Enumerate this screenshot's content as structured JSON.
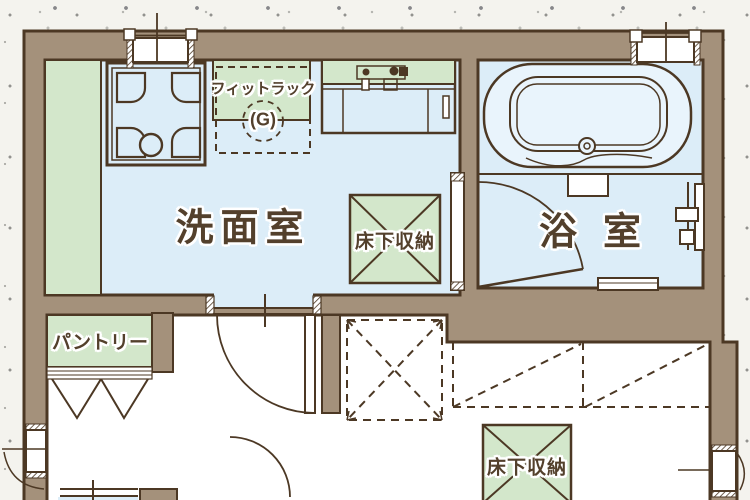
{
  "plan": {
    "rooms": {
      "washroom": {
        "label": "洗面室"
      },
      "bathroom": {
        "label": "浴室"
      },
      "pantry": {
        "label": "パントリー"
      }
    },
    "labels": {
      "fitrack": "フィットラック",
      "fitrack_sub": "(G)",
      "underfloor_storage_1": "床下収納",
      "underfloor_storage_2": "床下収納"
    },
    "colors": {
      "wall": "#a4917b",
      "room_floor": "#dcedf8",
      "tub_fill": "#e9f4fc",
      "storage_green": "#d3e7cb",
      "outline": "#4c3824",
      "background": "#f4f3ee"
    }
  }
}
